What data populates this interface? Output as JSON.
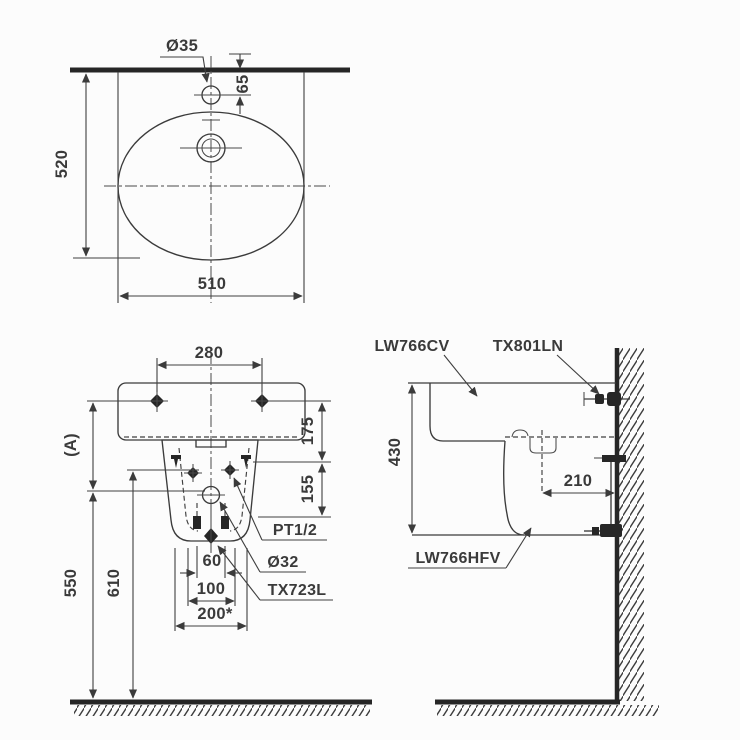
{
  "drawing": {
    "background": "#fcfcfc",
    "line_color": "#3b3b3b",
    "text_color": "#3a3a3a"
  },
  "top_view": {
    "faucet_hole_diameter": "Ø35",
    "faucet_hole_to_wall": "65",
    "basin_depth": "520",
    "basin_width": "510"
  },
  "front_view": {
    "bolt_hole_spacing": "280",
    "rim_to_supply": "175",
    "supply_to_trap": "155",
    "reference_height": "(A)",
    "trap_height": "550",
    "supply_height": "610",
    "trap_offset": "60",
    "outlet_spacing": "100",
    "pedestal_width": "200*",
    "supply_connection": "PT1/2",
    "waste_diameter": "Ø32",
    "trap_model": "TX723L"
  },
  "side_view": {
    "rim_to_bracket": "430",
    "overflow_to_wall": "210",
    "basin_model": "LW766CV",
    "bracket_model": "TX801LN",
    "pedestal_model": "LW766HFV"
  }
}
